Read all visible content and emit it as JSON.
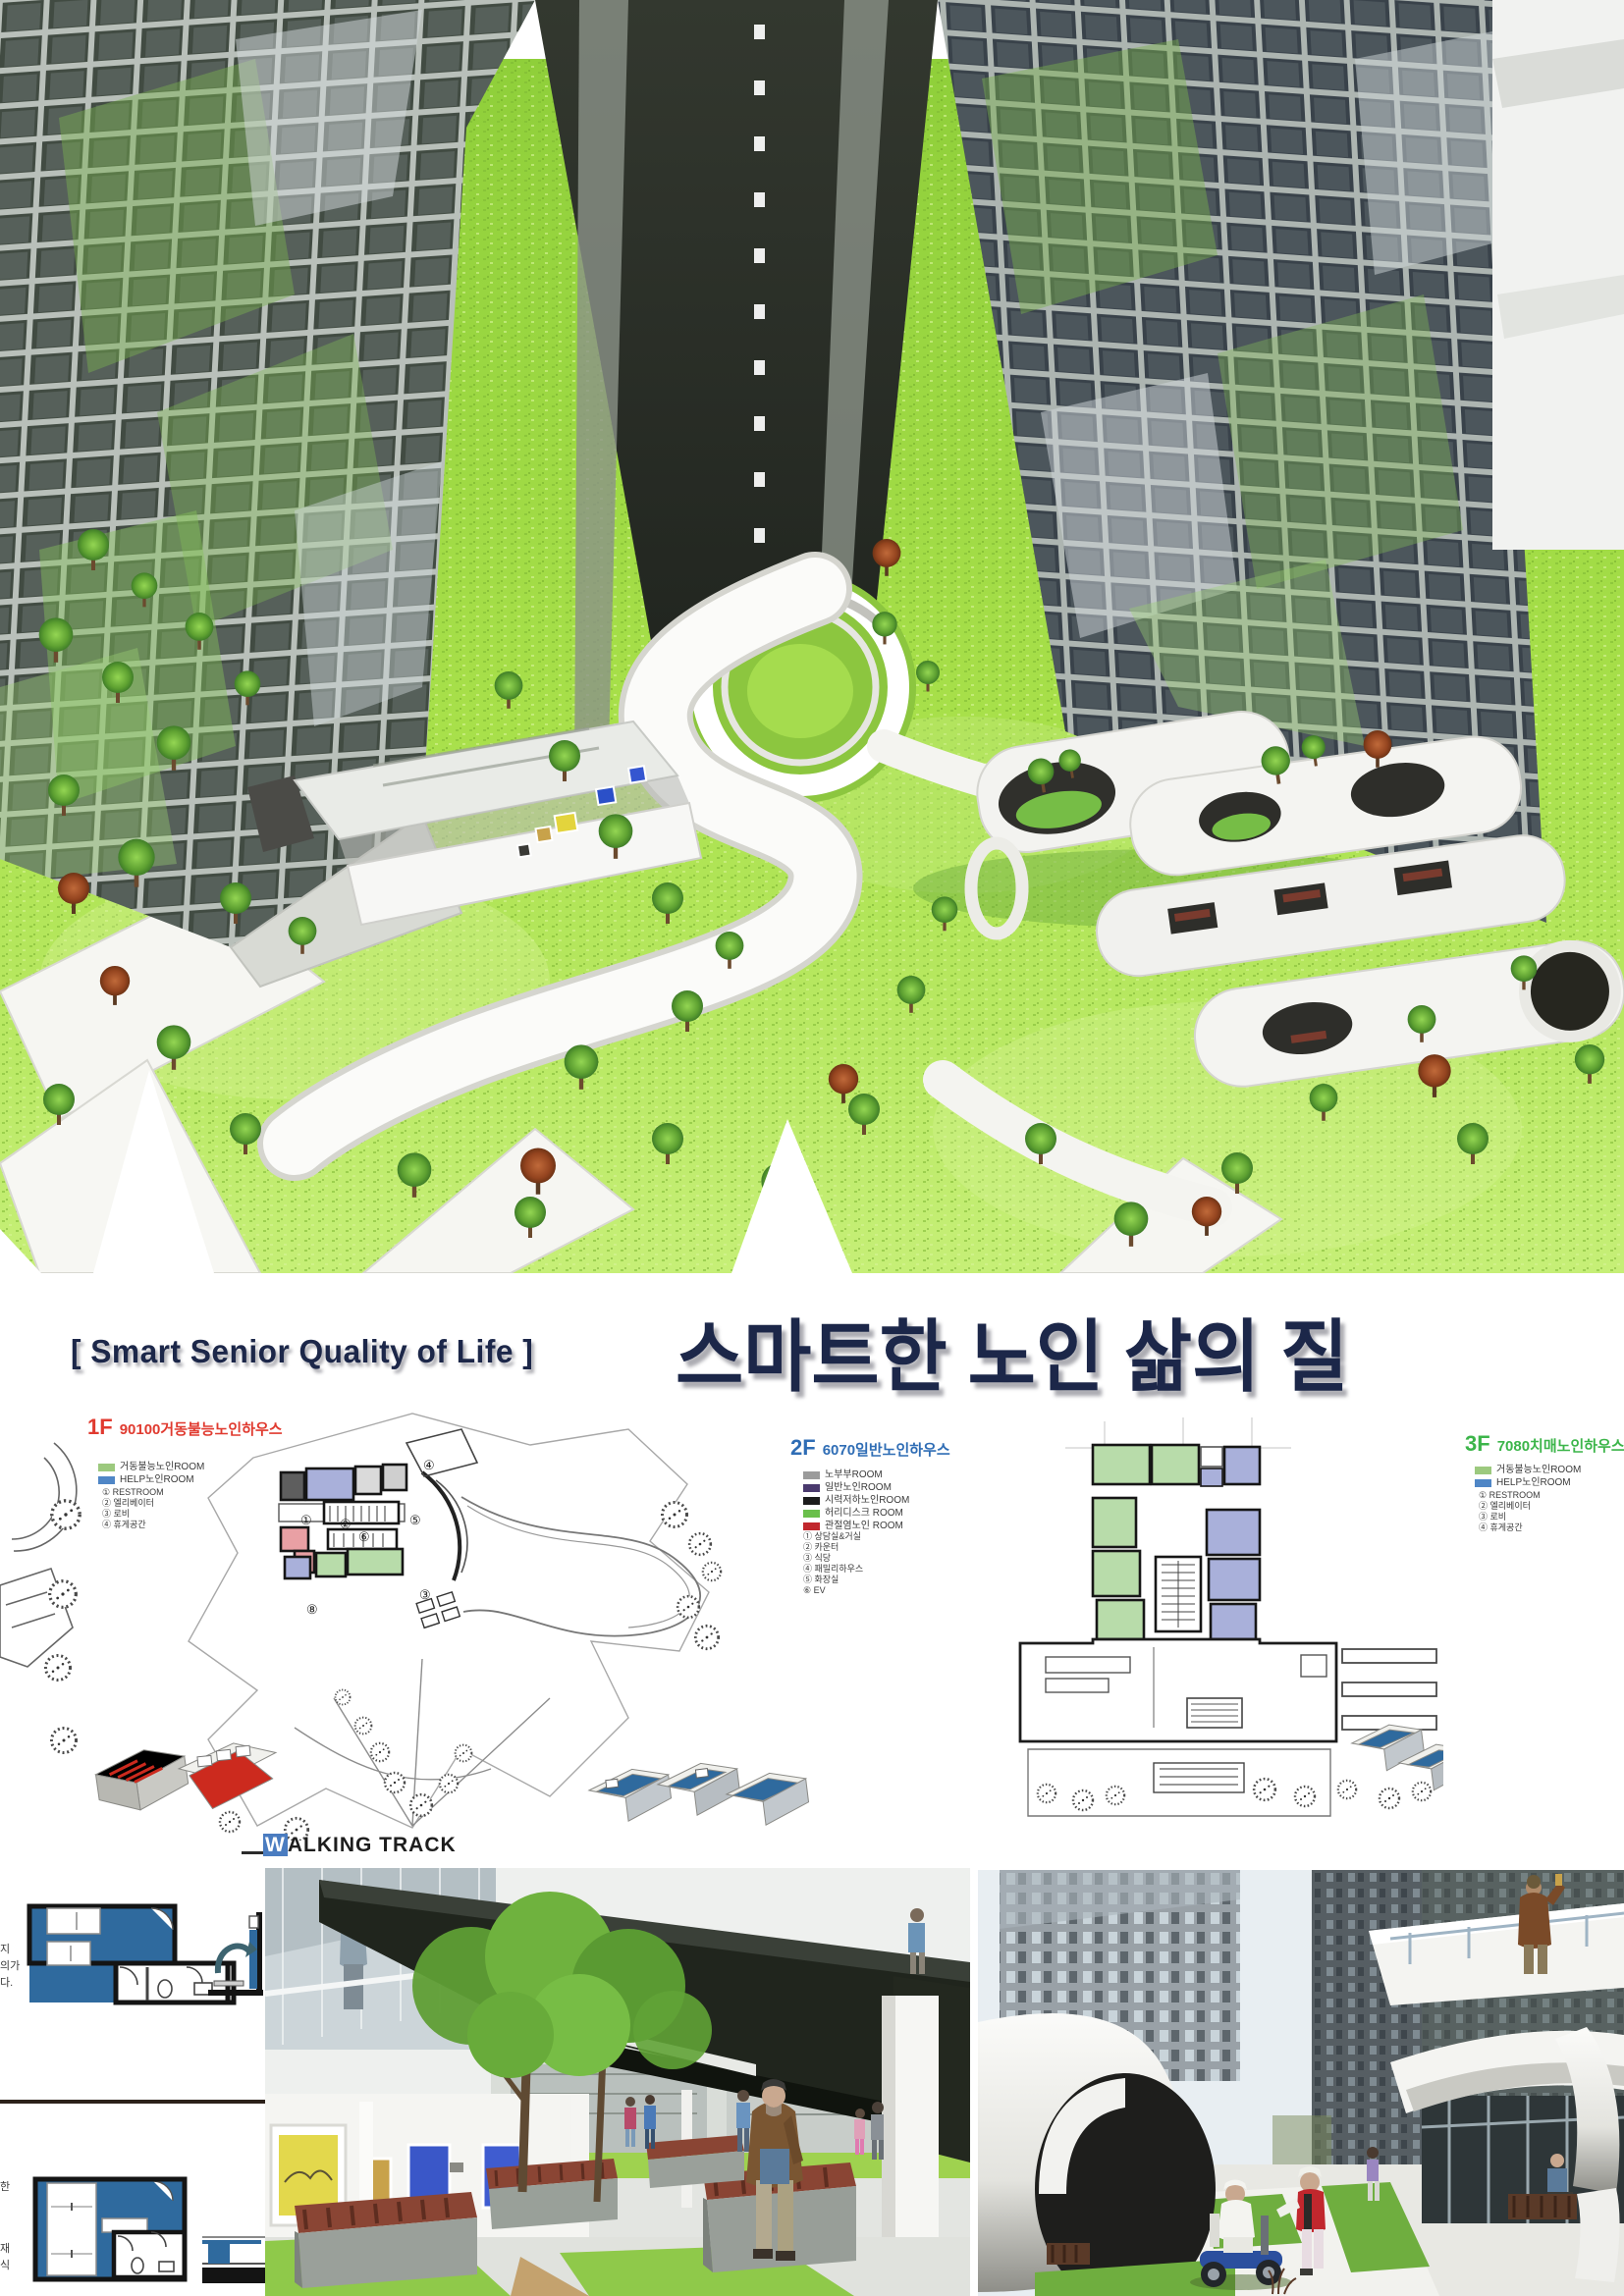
{
  "poster": {
    "title_en": "[ Smart Senior Quality of Life ]",
    "title_ko": "스마트한 노인 삶의 질"
  },
  "palette": {
    "title_navy": "#1c2749",
    "f1_accent": "#e03a2f",
    "f2_accent": "#2f6db5",
    "f3_accent": "#3cb54a",
    "track_highlight": "#4a7cc0",
    "unit_blue": "#2f6a9e",
    "grass_green": "#a2d94a"
  },
  "plans": {
    "f1": {
      "floor": "1F",
      "name": "90100거동불능노인하우스",
      "legend": [
        {
          "color": "#9cc97e",
          "label": "거동불능노인ROOM"
        },
        {
          "color": "#4f86c6",
          "label": "HELP노인ROOM"
        }
      ],
      "items": [
        "① RESTROOM",
        "② 엘리베이터",
        "③ 로비",
        "④ 휴게공간"
      ],
      "markers": [
        "①",
        "②",
        "③",
        "④",
        "⑤",
        "⑥",
        "⑧"
      ]
    },
    "f2": {
      "floor": "2F",
      "name": "6070일반노인하우스",
      "legend": [
        {
          "color": "#9b9b9b",
          "label": "노부부ROOM"
        },
        {
          "color": "#4a3a6e",
          "label": "일반노인ROOM"
        },
        {
          "color": "#1c1c1c",
          "label": "시력저하노인ROOM"
        },
        {
          "color": "#6abf4b",
          "label": "허리디스크 ROOM"
        },
        {
          "color": "#c1272d",
          "label": "관절염노인 ROOM"
        }
      ],
      "items": [
        "① 상담실&거실",
        "② 카운터",
        "③ 식당",
        "④ 패밀리하우스",
        "⑤ 화장실",
        "⑥ EV"
      ]
    },
    "f3": {
      "floor": "3F",
      "name": "7080치매노인하우스",
      "legend": [
        {
          "color": "#9cc97e",
          "label": "거동불능노인ROOM"
        },
        {
          "color": "#4f86c6",
          "label": "HELP노인ROOM"
        }
      ],
      "items": [
        "① RESTROOM",
        "② 엘리베이터",
        "③ 로비",
        "④ 휴게공간"
      ]
    }
  },
  "walking_track": {
    "highlight": "W",
    "rest": "ALKING TRACK"
  },
  "margin_notes": {
    "top": [
      "지",
      "의가",
      "다."
    ],
    "bottom": [
      "한",
      "재",
      "식"
    ]
  }
}
